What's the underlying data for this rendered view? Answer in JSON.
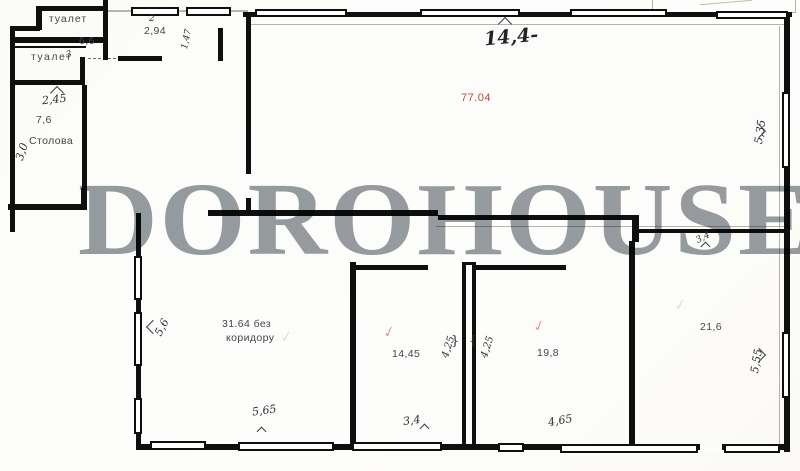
{
  "watermark": "DOROHOUSE",
  "colors": {
    "area_total_red": "#c44536",
    "check_pink": "#e59aa6",
    "watermark_gray": "#979ca2",
    "wall_ink": "#0f0f0f"
  },
  "icons": {
    "check": "✓"
  },
  "rooms": {
    "toilet_top": {
      "label": "туалет"
    },
    "toilet_mid": {
      "label": "туалет",
      "mark": "3"
    },
    "dining": {
      "label": "Столова",
      "area": "7,6"
    },
    "hall": {
      "area": "77.04"
    },
    "room_left": {
      "area_line1": "31.64 без",
      "area_line2": "коридору"
    },
    "room_mid": {
      "area": "14,45"
    },
    "room_right": {
      "area": "19,8"
    },
    "room_far_right": {
      "area": "21,6"
    }
  },
  "dimensions": {
    "wall_6_6": "6,6",
    "vestibule_mark": "2",
    "vestibule_width": "2,94",
    "vestibule_depth": "1,47",
    "dining_width": "2,45",
    "dining_depth": "3,0",
    "hall_width": "14,4-",
    "hall_depth": "5,35",
    "corridor_notch": "3,4",
    "room_left_depth": "5,6",
    "room_left_width": "5,65",
    "room_mid_depth_left": "4,25",
    "room_mid_depth_right": "4,25",
    "room_mid_width": "3,4",
    "room_right_width": "4,65",
    "room_far_right_depth": "5,55"
  },
  "glyphs": {
    "brace_left": "}",
    "brace_right": "{"
  }
}
